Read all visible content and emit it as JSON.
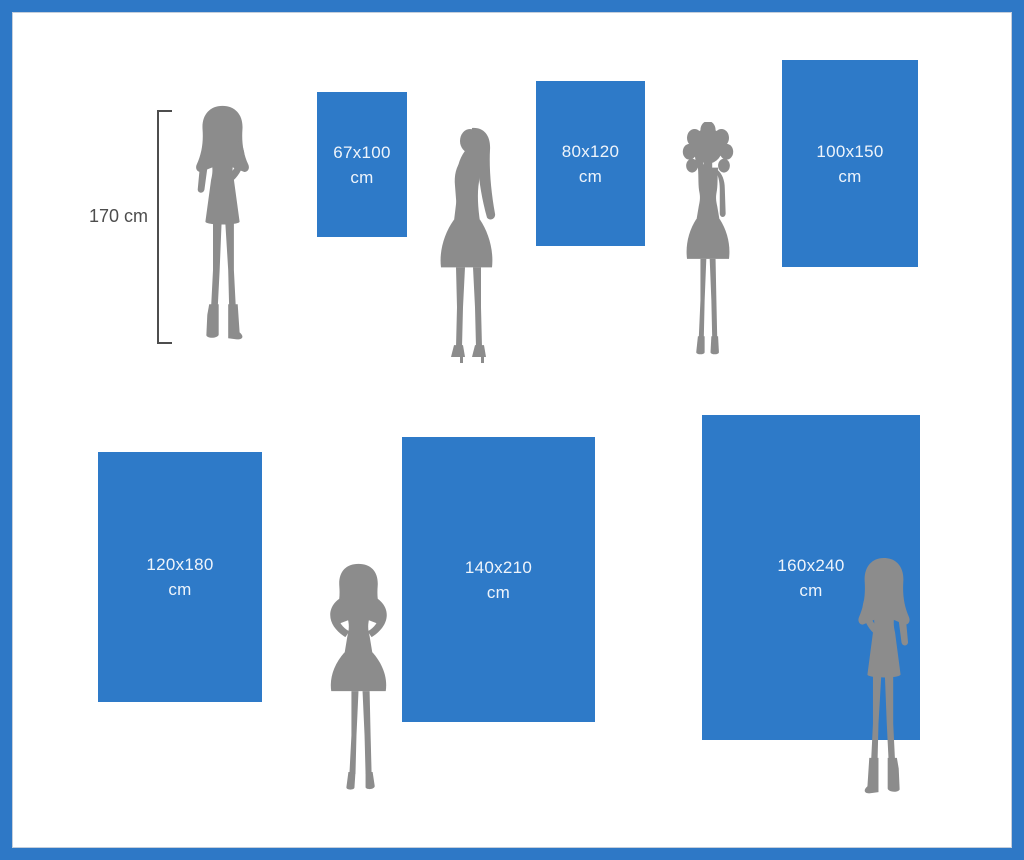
{
  "colors": {
    "frame_blue": "#2e78c6",
    "rect_blue": "#2e7ac8",
    "rect_text": "#eef4fb",
    "silhouette_gray": "#8c8c8c",
    "measure_gray": "#4d4d4d"
  },
  "measure": {
    "label": "170 cm"
  },
  "sizes": [
    {
      "dimensions": "67x100",
      "unit": "cm",
      "width_cm": 67,
      "height_cm": 100
    },
    {
      "dimensions": "80x120",
      "unit": "cm",
      "width_cm": 80,
      "height_cm": 120
    },
    {
      "dimensions": "100x150",
      "unit": "cm",
      "width_cm": 100,
      "height_cm": 150
    },
    {
      "dimensions": "120x180",
      "unit": "cm",
      "width_cm": 120,
      "height_cm": 180
    },
    {
      "dimensions": "140x210",
      "unit": "cm",
      "width_cm": 140,
      "height_cm": 210
    },
    {
      "dimensions": "160x240",
      "unit": "cm",
      "width_cm": 160,
      "height_cm": 240
    }
  ]
}
